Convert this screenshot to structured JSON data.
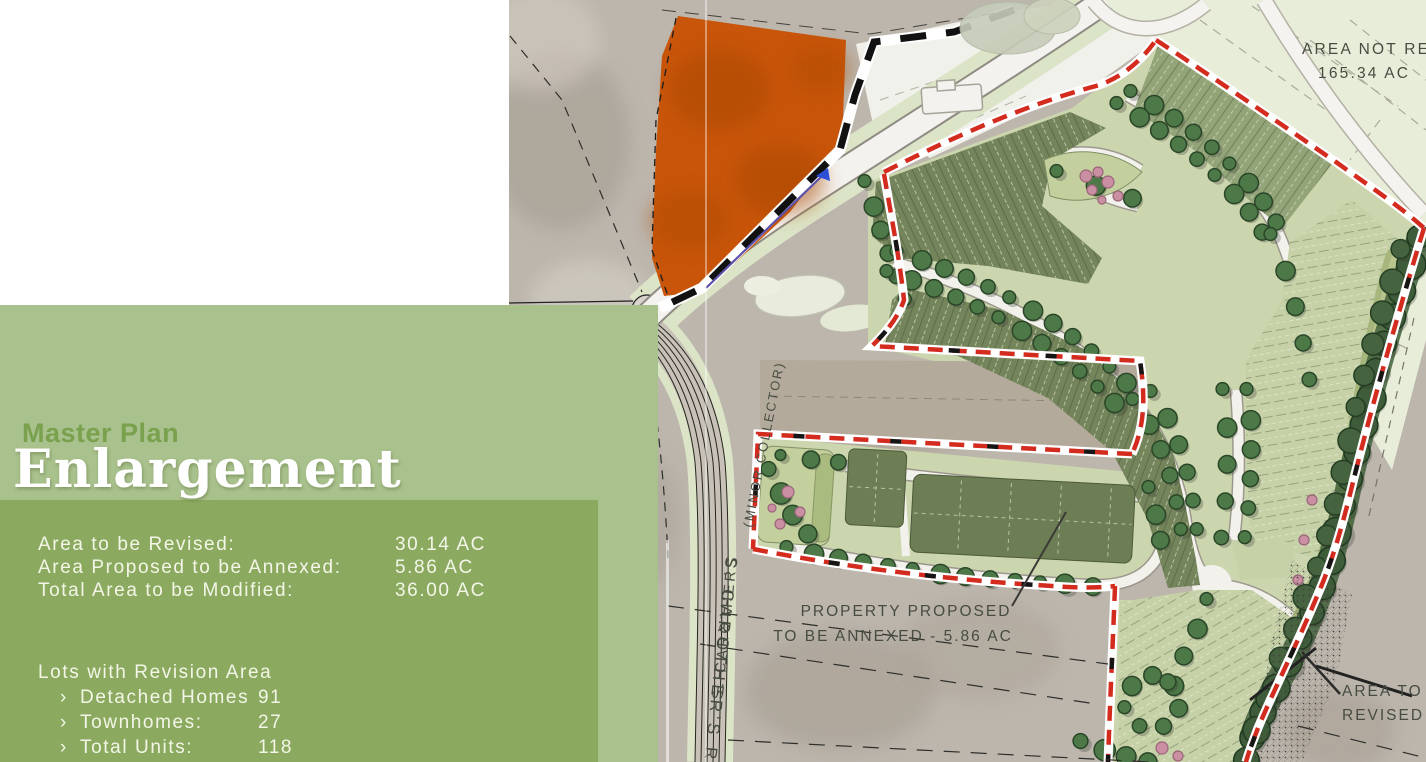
{
  "panel": {
    "subtitle": "Master Plan",
    "title": "Enlargement",
    "stats": [
      {
        "label": "Area to be Revised:",
        "value": "30.14 AC"
      },
      {
        "label": "Area Proposed to be Annexed:",
        "value": "5.86 AC"
      },
      {
        "label": "Total Area to be Modified:",
        "value": "36.00 AC"
      }
    ],
    "lots": {
      "heading": "Lots with Revision Area",
      "items": [
        {
          "bullet": "›",
          "label": "Detached Homes",
          "value": "91"
        },
        {
          "bullet": "›",
          "label": "Townhomes:",
          "value": "27"
        },
        {
          "bullet": "›",
          "label": "Total Units:",
          "value": "118"
        }
      ]
    }
  },
  "map": {
    "labels": {
      "area_not_revised": "AREA NOT REVISED",
      "area_not_revised_acreage": "165.34 AC",
      "annex_line1": "PROPERTY PROPOSED",
      "annex_line2": "TO BE ANNEXED - 5.86 AC",
      "area_revised_line1": "AREA TO BE",
      "area_revised_line2": "REVISED - ",
      "road_minor_collector": "(MINOR COLLECTOR)",
      "road_name": "S. CAROTHERS",
      "road_name_bold": "S. CAROTHER'S RD"
    },
    "colors": {
      "revision_boundary_red": "#d32b1e",
      "annex_parcel_orange": "#c85509",
      "panel_light_green": "#a9c18c",
      "panel_dark_green": "#8baa60",
      "lot_olive": "#75855b",
      "lot_pale": "#c6d1a8"
    }
  }
}
